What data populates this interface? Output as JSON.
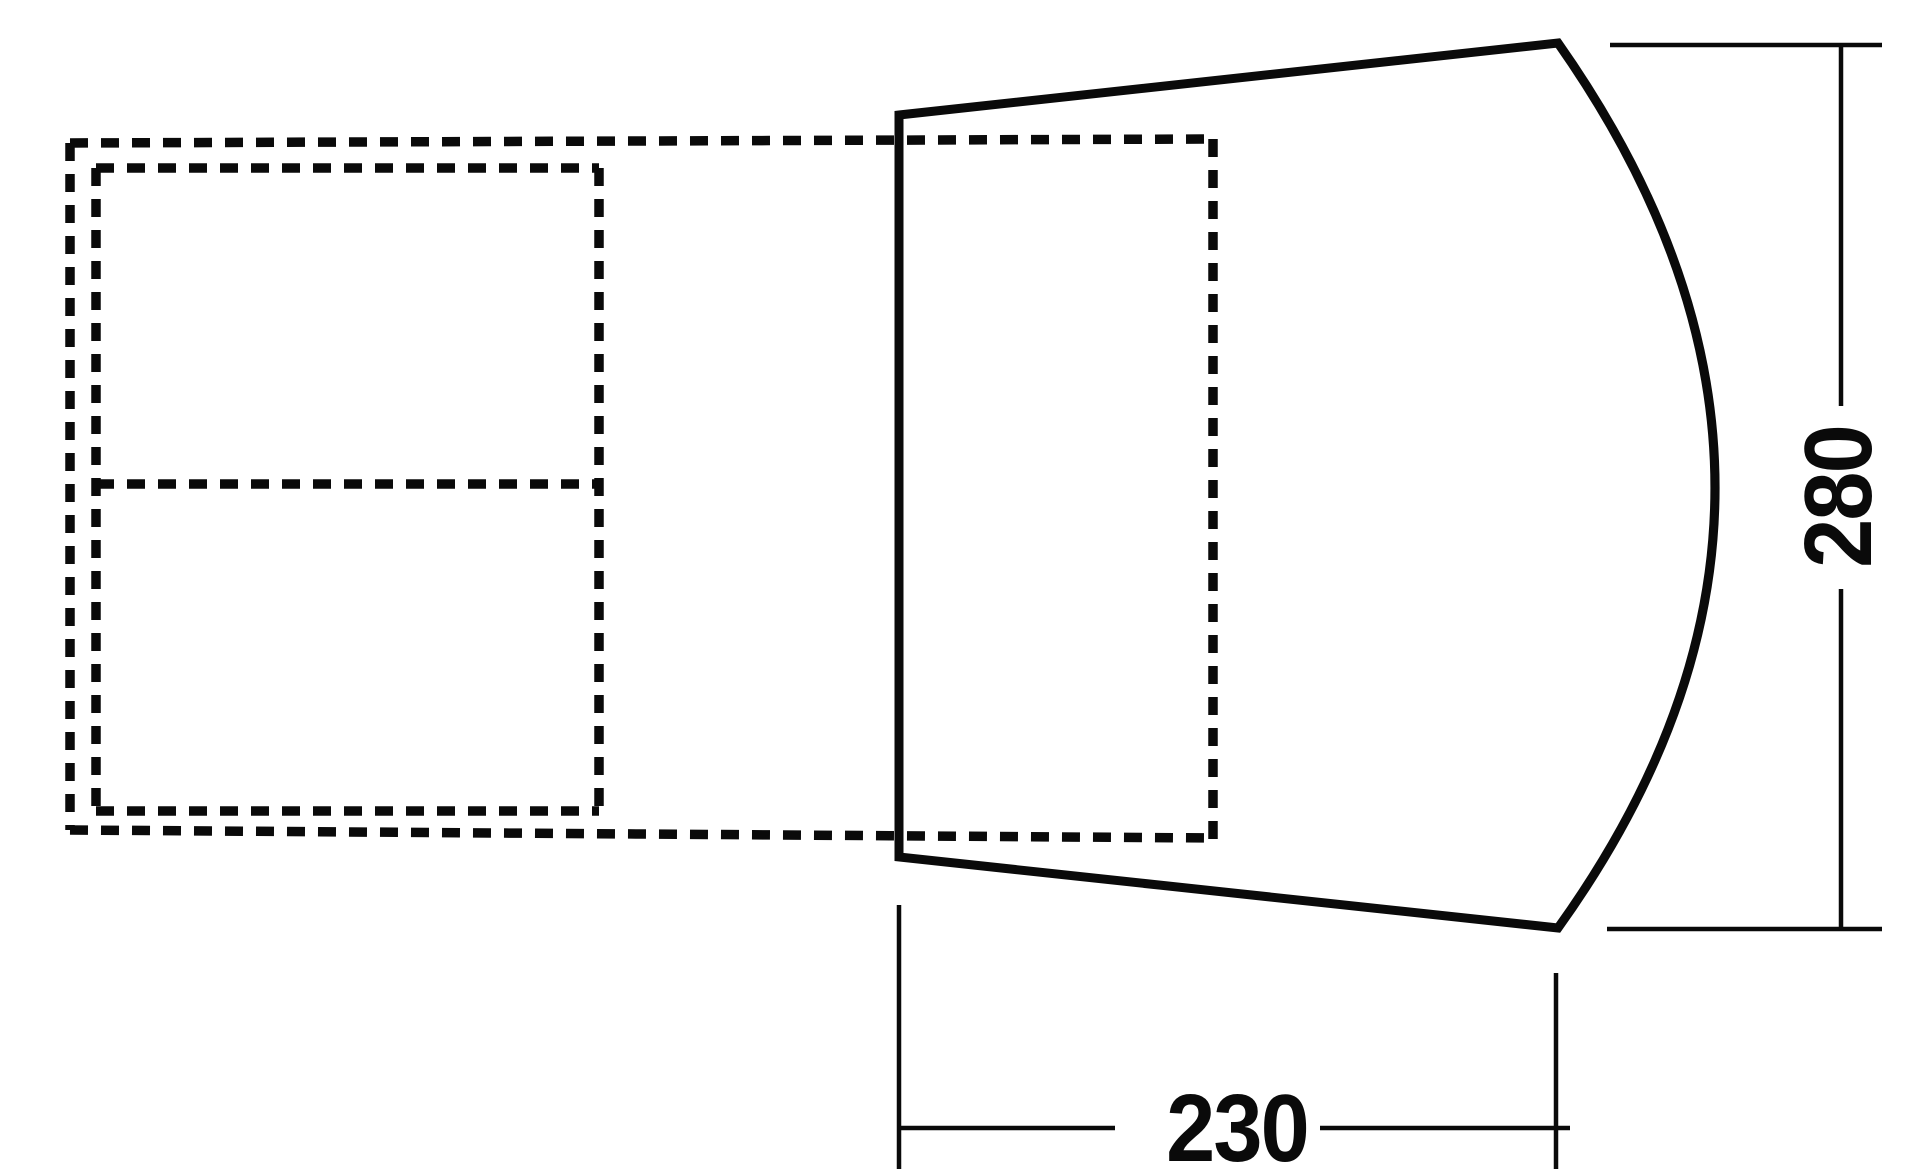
{
  "diagram": {
    "title": "tent-floorplan-top-view",
    "background_color": "#ffffff",
    "line_color": "#0a0a0a",
    "shapes": {
      "tent_body": "solid trapezoid with curved right end",
      "awning": "dashed outline attached to left side of tent body",
      "inner_cabin": "dashed rectangle with center divider inside awning area",
      "inner_cabin_2": "dashed rectangle inside tent body"
    },
    "dimensions": [
      {
        "id": "depth",
        "value": "280",
        "orientation": "vertical",
        "position": "right"
      },
      {
        "id": "width",
        "value": "230",
        "orientation": "horizontal",
        "position": "bottom"
      }
    ]
  }
}
